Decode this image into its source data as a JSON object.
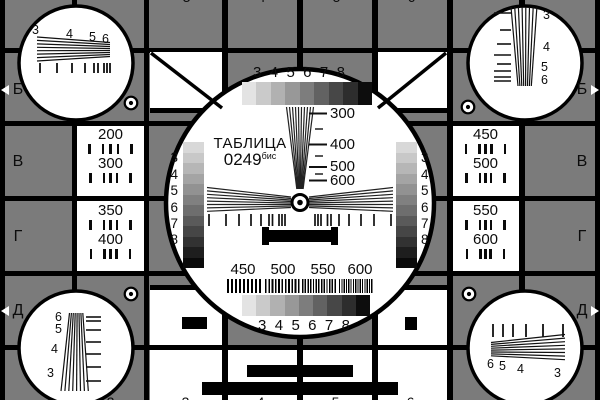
{
  "card": {
    "title": "ТАБЛИЦА",
    "number": "0249",
    "number_suffix": "бис",
    "colors": {
      "background_gray": "#7b7b7b",
      "grid_black": "#000000",
      "cell_white": "#ffffff",
      "text": "#0c0c0c"
    },
    "grayscale_steps": [
      "#e3e3e3",
      "#cacaca",
      "#b1b1b1",
      "#989898",
      "#7d7d7d",
      "#626262",
      "#474747",
      "#2d2d2d",
      "#0d0d0d"
    ],
    "column_steps": [
      "#d8d8d8",
      "#c8c8c8",
      "#b6b6b6",
      "#a4a4a4",
      "#929292",
      "#808080",
      "#6e6e6e",
      "#5a5a5a",
      "#464646",
      "#323232",
      "#1e1e1e",
      "#0a0a0a"
    ],
    "top_scale": {
      "labels": [
        "3",
        "4",
        "5",
        "6",
        "7",
        "8"
      ]
    },
    "bottom_scale": {
      "labels": [
        "3",
        "4",
        "5",
        "6",
        "7",
        "8"
      ]
    },
    "left_column": {
      "labels": [
        "3",
        "4",
        "5",
        "6",
        "7",
        "8"
      ]
    },
    "right_column": {
      "labels": [
        "3",
        "4",
        "5",
        "6",
        "7",
        "8"
      ]
    },
    "wedge_ruler": {
      "marks": [
        "300",
        "400",
        "500",
        "600"
      ]
    },
    "burst": {
      "labels": [
        "450",
        "500",
        "550",
        "600"
      ]
    },
    "row_letters": [
      "Б",
      "В",
      "Г",
      "Д"
    ],
    "left_cells": [
      {
        "a": "200",
        "b": "300"
      },
      {
        "a": "350",
        "b": "400"
      }
    ],
    "right_cells": [
      {
        "a": "450",
        "b": "500"
      },
      {
        "a": "550",
        "b": "600"
      }
    ],
    "corner_circles": {
      "top_left": [
        "3",
        "4",
        "5",
        "6"
      ],
      "top_right": [
        "3",
        "4",
        "5",
        "6"
      ],
      "bottom_left": [
        "6",
        "5",
        "4",
        "3"
      ],
      "bottom_right": [
        "6",
        "5",
        "4",
        "3"
      ]
    },
    "edge_digits": {
      "top": [
        "3",
        "4",
        "5",
        "6"
      ],
      "bottom": [
        "2",
        "3",
        "4",
        "5",
        "6"
      ]
    }
  }
}
